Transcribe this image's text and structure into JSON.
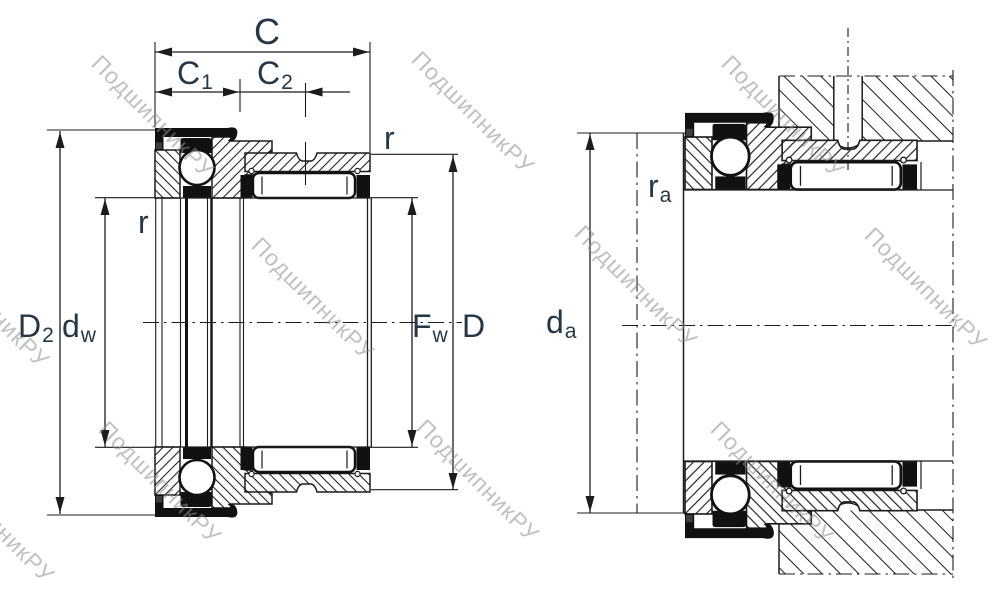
{
  "watermark": {
    "text": "ПодшипникРУ"
  },
  "colors": {
    "line": "#1c1c1c",
    "blk": "#111111",
    "label": "#253746",
    "watermark": "#8e8e8e"
  },
  "labels": {
    "c": "C",
    "c1_base": "C",
    "c1_sub": "1",
    "c2_base": "C",
    "c2_sub": "2",
    "r_top_right": "r",
    "r_left": "r",
    "d2_base": "D",
    "d2_sub": "2",
    "dw_base": "d",
    "dw_sub": "w",
    "fw_base": "F",
    "fw_sub": "w",
    "d": "D",
    "da_base": "d",
    "da_sub": "a",
    "ra_base": "r",
    "ra_sub": "a"
  }
}
